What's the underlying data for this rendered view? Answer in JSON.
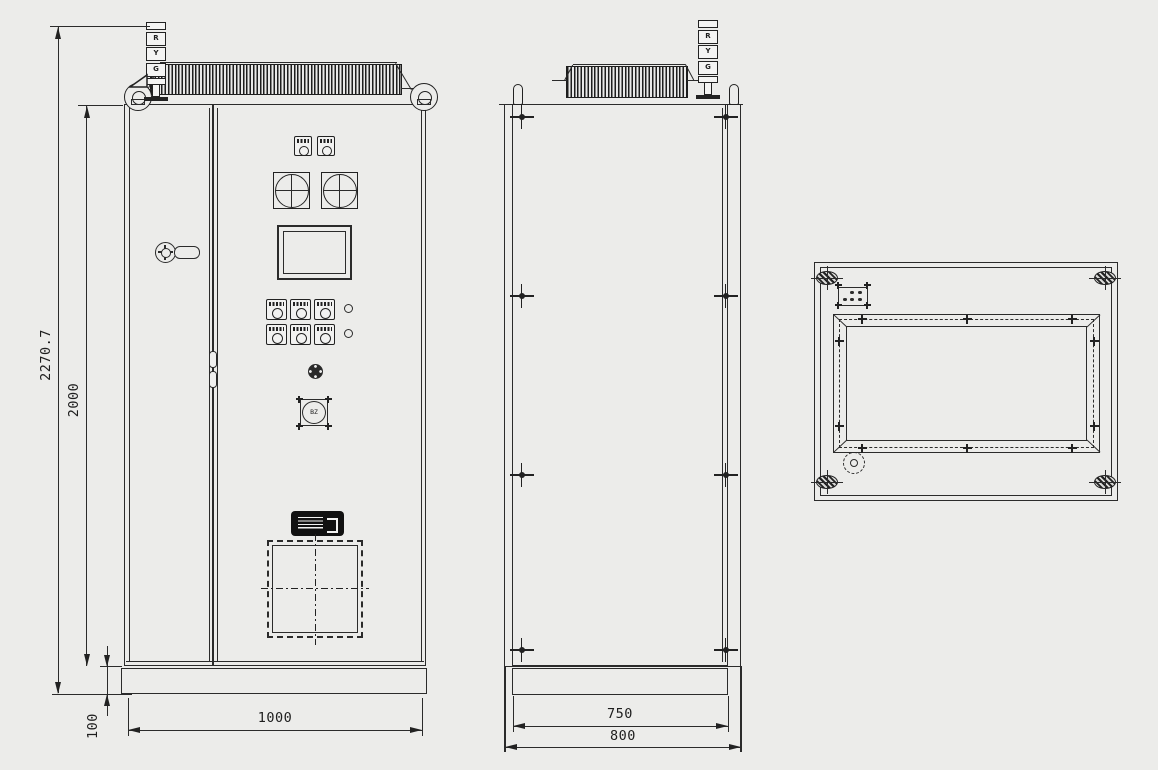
{
  "drawing": {
    "background_color": "#ececea",
    "line_color": "#2b2b2b"
  },
  "front_view": {
    "signal_tower_segments": [
      "R",
      "Y",
      "G"
    ],
    "buzzer_label": "BZ",
    "dim_overall_height": "2270.7",
    "dim_body_height": "2000",
    "dim_base_height": "100",
    "dim_width": "1000"
  },
  "side_view": {
    "signal_tower_segments": [
      "R",
      "Y",
      "G"
    ],
    "dim_depth_body": "750",
    "dim_depth_overall": "800"
  }
}
